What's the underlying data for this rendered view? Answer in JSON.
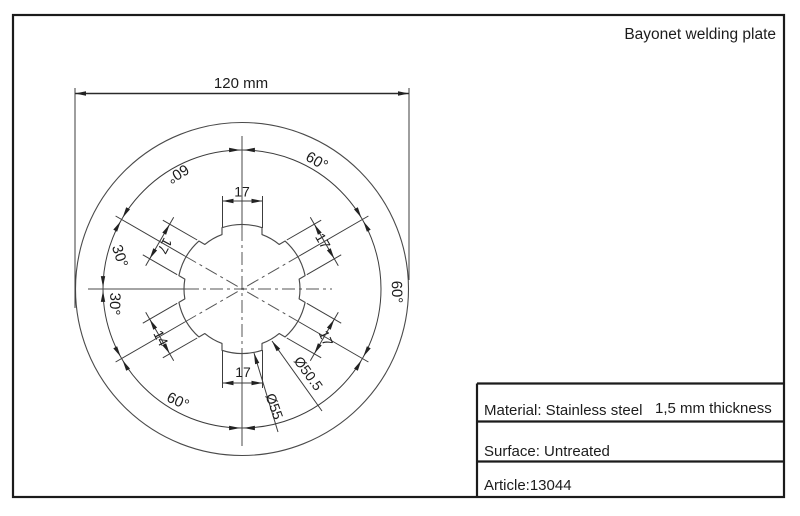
{
  "page": {
    "title": "Bayonet welding plate"
  },
  "drawing": {
    "overall_width": "120 mm",
    "dims": {
      "tab_top": "17",
      "tab_ne": "17",
      "tab_nw": "17",
      "tab_se": "17",
      "tab_sw": "14",
      "tab_bottom": "17"
    },
    "angles": {
      "top_right": "60°",
      "top_left": "60°",
      "left_upper": "30°",
      "left_lower": "30°",
      "right": "60°",
      "bottom_left": "60°"
    },
    "diameters": {
      "inner": "Ø50.5",
      "outer": "Ø55"
    }
  },
  "title_block": {
    "material": "Material: Stainless steel",
    "thickness": "1,5 mm thickness",
    "surface": "Surface: Untreated",
    "article": "Article:13044"
  }
}
